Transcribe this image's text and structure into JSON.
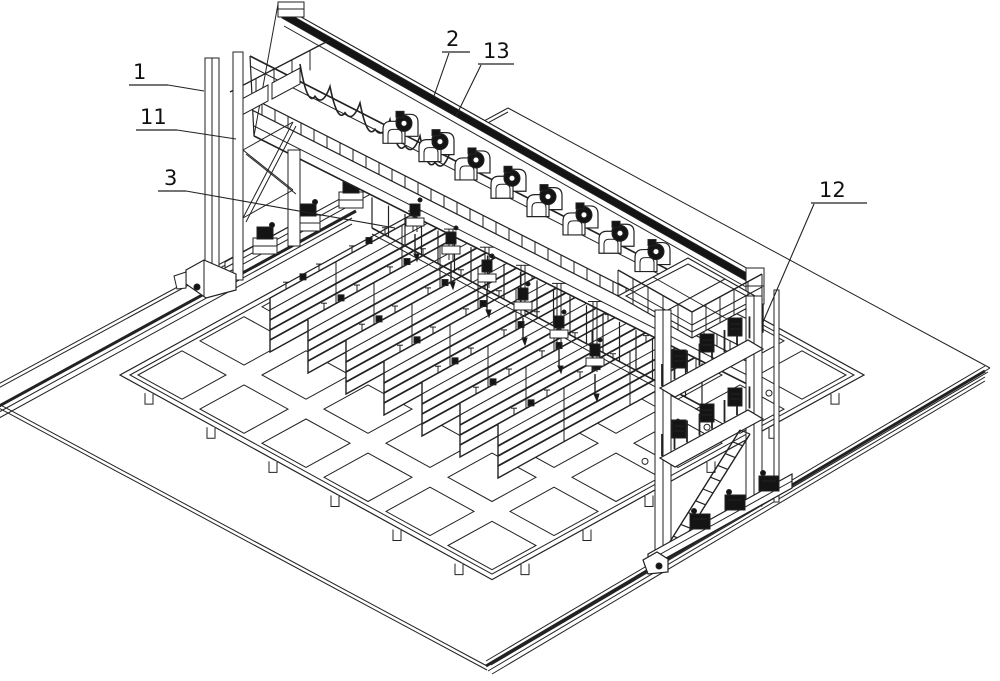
{
  "figure": {
    "background": "#ffffff",
    "line_color": "#222222",
    "dark_fill": "#141414",
    "annotations": [
      {
        "label": "1",
        "text": [
          133,
          79
        ],
        "underline": [
          [
            129,
            85
          ],
          [
            168,
            85
          ]
        ],
        "leader": [
          [
            168,
            85
          ],
          [
            204,
            91
          ]
        ],
        "target": "gantry-left-column"
      },
      {
        "label": "11",
        "text": [
          140,
          124
        ],
        "underline": [
          [
            136,
            130
          ],
          [
            177,
            130
          ]
        ],
        "leader": [
          [
            177,
            130
          ],
          [
            236,
            139
          ]
        ],
        "target": "left-column-leg"
      },
      {
        "label": "3",
        "text": [
          164,
          185
        ],
        "underline": [
          [
            158,
            191
          ],
          [
            186,
            191
          ]
        ],
        "leader": [
          [
            186,
            191
          ],
          [
            395,
            228
          ]
        ],
        "target": "welding-torch-unit"
      },
      {
        "label": "2",
        "text": [
          446,
          46
        ],
        "underline": [
          [
            442,
            52
          ],
          [
            470,
            52
          ]
        ],
        "leader": [
          [
            449,
            53
          ],
          [
            434,
            96
          ]
        ],
        "target": "beam-guide-rail"
      },
      {
        "label": "13",
        "text": [
          483,
          58
        ],
        "underline": [
          [
            478,
            64
          ],
          [
            514,
            64
          ]
        ],
        "leader": [
          [
            481,
            65
          ],
          [
            456,
            116
          ]
        ],
        "target": "carriage-track"
      },
      {
        "label": "12",
        "text": [
          819,
          197
        ],
        "underline": [
          [
            811,
            203
          ],
          [
            867,
            203
          ]
        ],
        "leader": [
          [
            814,
            204
          ],
          [
            763,
            322
          ]
        ],
        "target": "right-column-frame"
      }
    ]
  }
}
